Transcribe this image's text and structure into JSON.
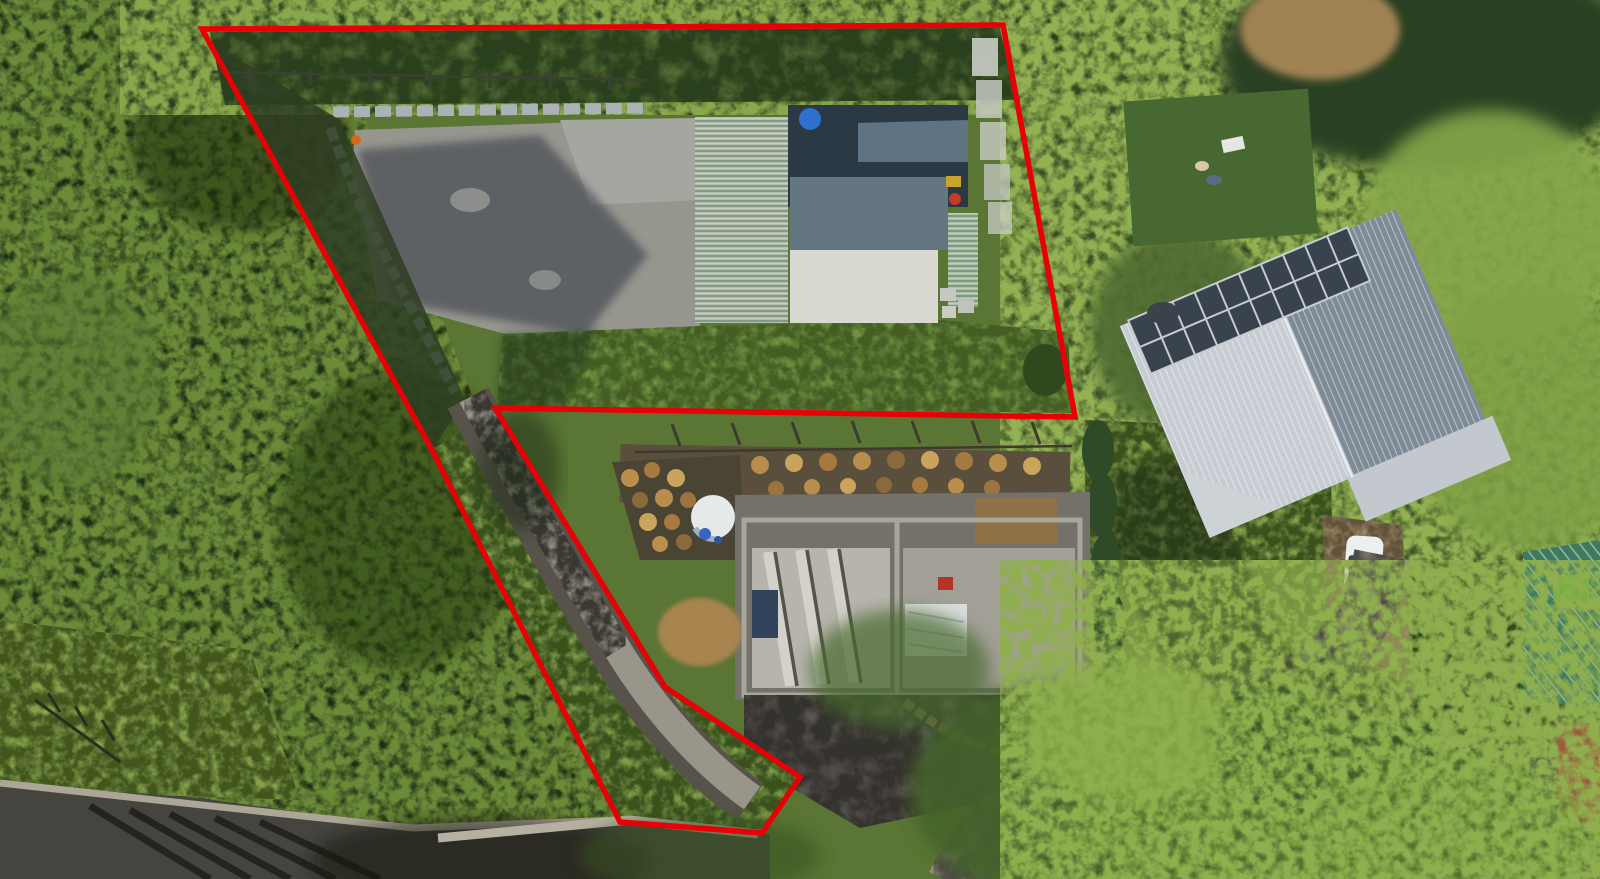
{
  "scene": {
    "type": "aerial-drone-photo",
    "subject": "residential property with red boundary outline overlay",
    "width": 1600,
    "height": 879
  },
  "boundary": {
    "color": "#e90006",
    "stroke_width": 5.5,
    "points_str": "202,29 1003,25 1075,417 495,408 665,687 800,777 762,833 620,822 432,450",
    "vertices": [
      {
        "x": 202,
        "y": 29
      },
      {
        "x": 1003,
        "y": 25
      },
      {
        "x": 1075,
        "y": 417
      },
      {
        "x": 495,
        "y": 408
      },
      {
        "x": 665,
        "y": 687
      },
      {
        "x": 800,
        "y": 777
      },
      {
        "x": 762,
        "y": 833
      },
      {
        "x": 620,
        "y": 822
      },
      {
        "x": 432,
        "y": 450
      }
    ]
  },
  "colors": {
    "forest_base": "#3b5023",
    "forest_dark": "#1f2d12",
    "forest_light": "#6c8a39",
    "veg_right": "#5a7534",
    "shrub_top": "#57713a",
    "grass_bright": "#87a14b",
    "lawn": "#6f9140",
    "strip_grass": "#7f9c48",
    "pad_gray": "#96968f",
    "pad_light": "#a6a6a1",
    "road_dark": "#45443f",
    "road_light": "#8f8b80",
    "shoulder": "#aba695",
    "path_gray": "#99958b",
    "rock_edge": "#57534a",
    "roof_sage": "#b2bfae",
    "roof_sage_strip": "#a9bfa6",
    "roof_slate_dark": "#2b3945",
    "roof_slate_steel": "#5f7383",
    "roof_slate_mid": "#64767f",
    "roof_light_panel": "#d9d9d2",
    "house_roof_light": "#c7ccd2",
    "house_roof_dark": "#7e8a96",
    "house_hip": "#cdd2d6",
    "porch": "#c2c8ce",
    "solar_dark": "#39434e",
    "solar_grid": "#c7ccd1",
    "teal_roof": "#3f7a5e",
    "tile_roof": "#9a5a3f",
    "dark_roof": "#3a3f42",
    "tarp": "#d9dcdd",
    "car_white": "#eceef0",
    "windshield": "#3a424a",
    "dirt_tan": "#a8844f",
    "dirt_patch": "#a08253",
    "soil_dark": "#5a4f3c",
    "tank_white": "#e6e9e9",
    "tank_blue": "#3565c0",
    "barrel_blue": "#2f6fd0",
    "wall_gray": "#aab2b6",
    "slab": "#b6b4ac",
    "slab2": "#a29f97",
    "con_ground": "#74716a",
    "con_wall": "#a8a59b",
    "navy_square": "#31445c",
    "red_item": "#b53326",
    "neighbor_lawn": "#476831",
    "drive_tan": "#9d8a66",
    "shadow": "#141d10"
  },
  "features": {
    "boundary_annotation": "red surveyed property outline (flag-shaped lot)",
    "shed": "green multi-pitch roof shed/garage inside boundary",
    "main_house": "neighbouring house with corrugated roof and rooftop solar array",
    "construction_site": "concrete slab foundation under construction with retaining walls",
    "water_tank": "round white/blue tank beside log-round garden mosaic",
    "white_car": "white car parked on tan driveway",
    "satellite_dish": "dark dish on house eave",
    "roads": "dark asphalt road bottom-left, light curved road bottom-right",
    "driveway_strip": "narrow flag driveway connecting lot to road",
    "vegetation": "dense casuarina forest left, fern canopy right, lawns and hedges"
  }
}
